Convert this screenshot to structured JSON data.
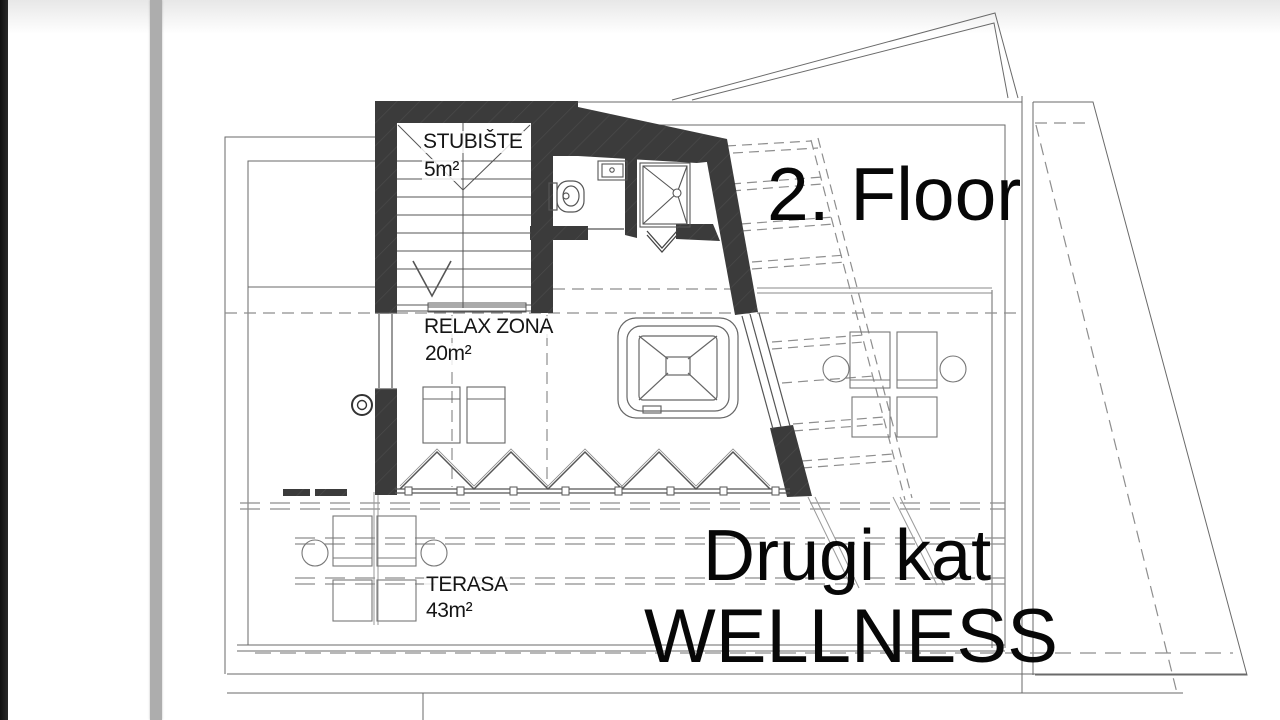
{
  "colors": {
    "wall": "#3b3b3b",
    "thin_line": "#6a6a6a",
    "dashed_line": "#8e8e8e",
    "text": "#070707"
  },
  "rooms": {
    "staircase": {
      "label": "STUBIŠTE",
      "area": "5m²"
    },
    "relax_zone": {
      "label": "RELAX ZONA",
      "area": "20m²"
    },
    "terrace": {
      "label": "TERASA",
      "area": "43m²"
    }
  },
  "annotations": {
    "floor_title_en": "2. Floor",
    "floor_title_hr": "Drugi kat",
    "zone_title": "WELLNESS"
  }
}
